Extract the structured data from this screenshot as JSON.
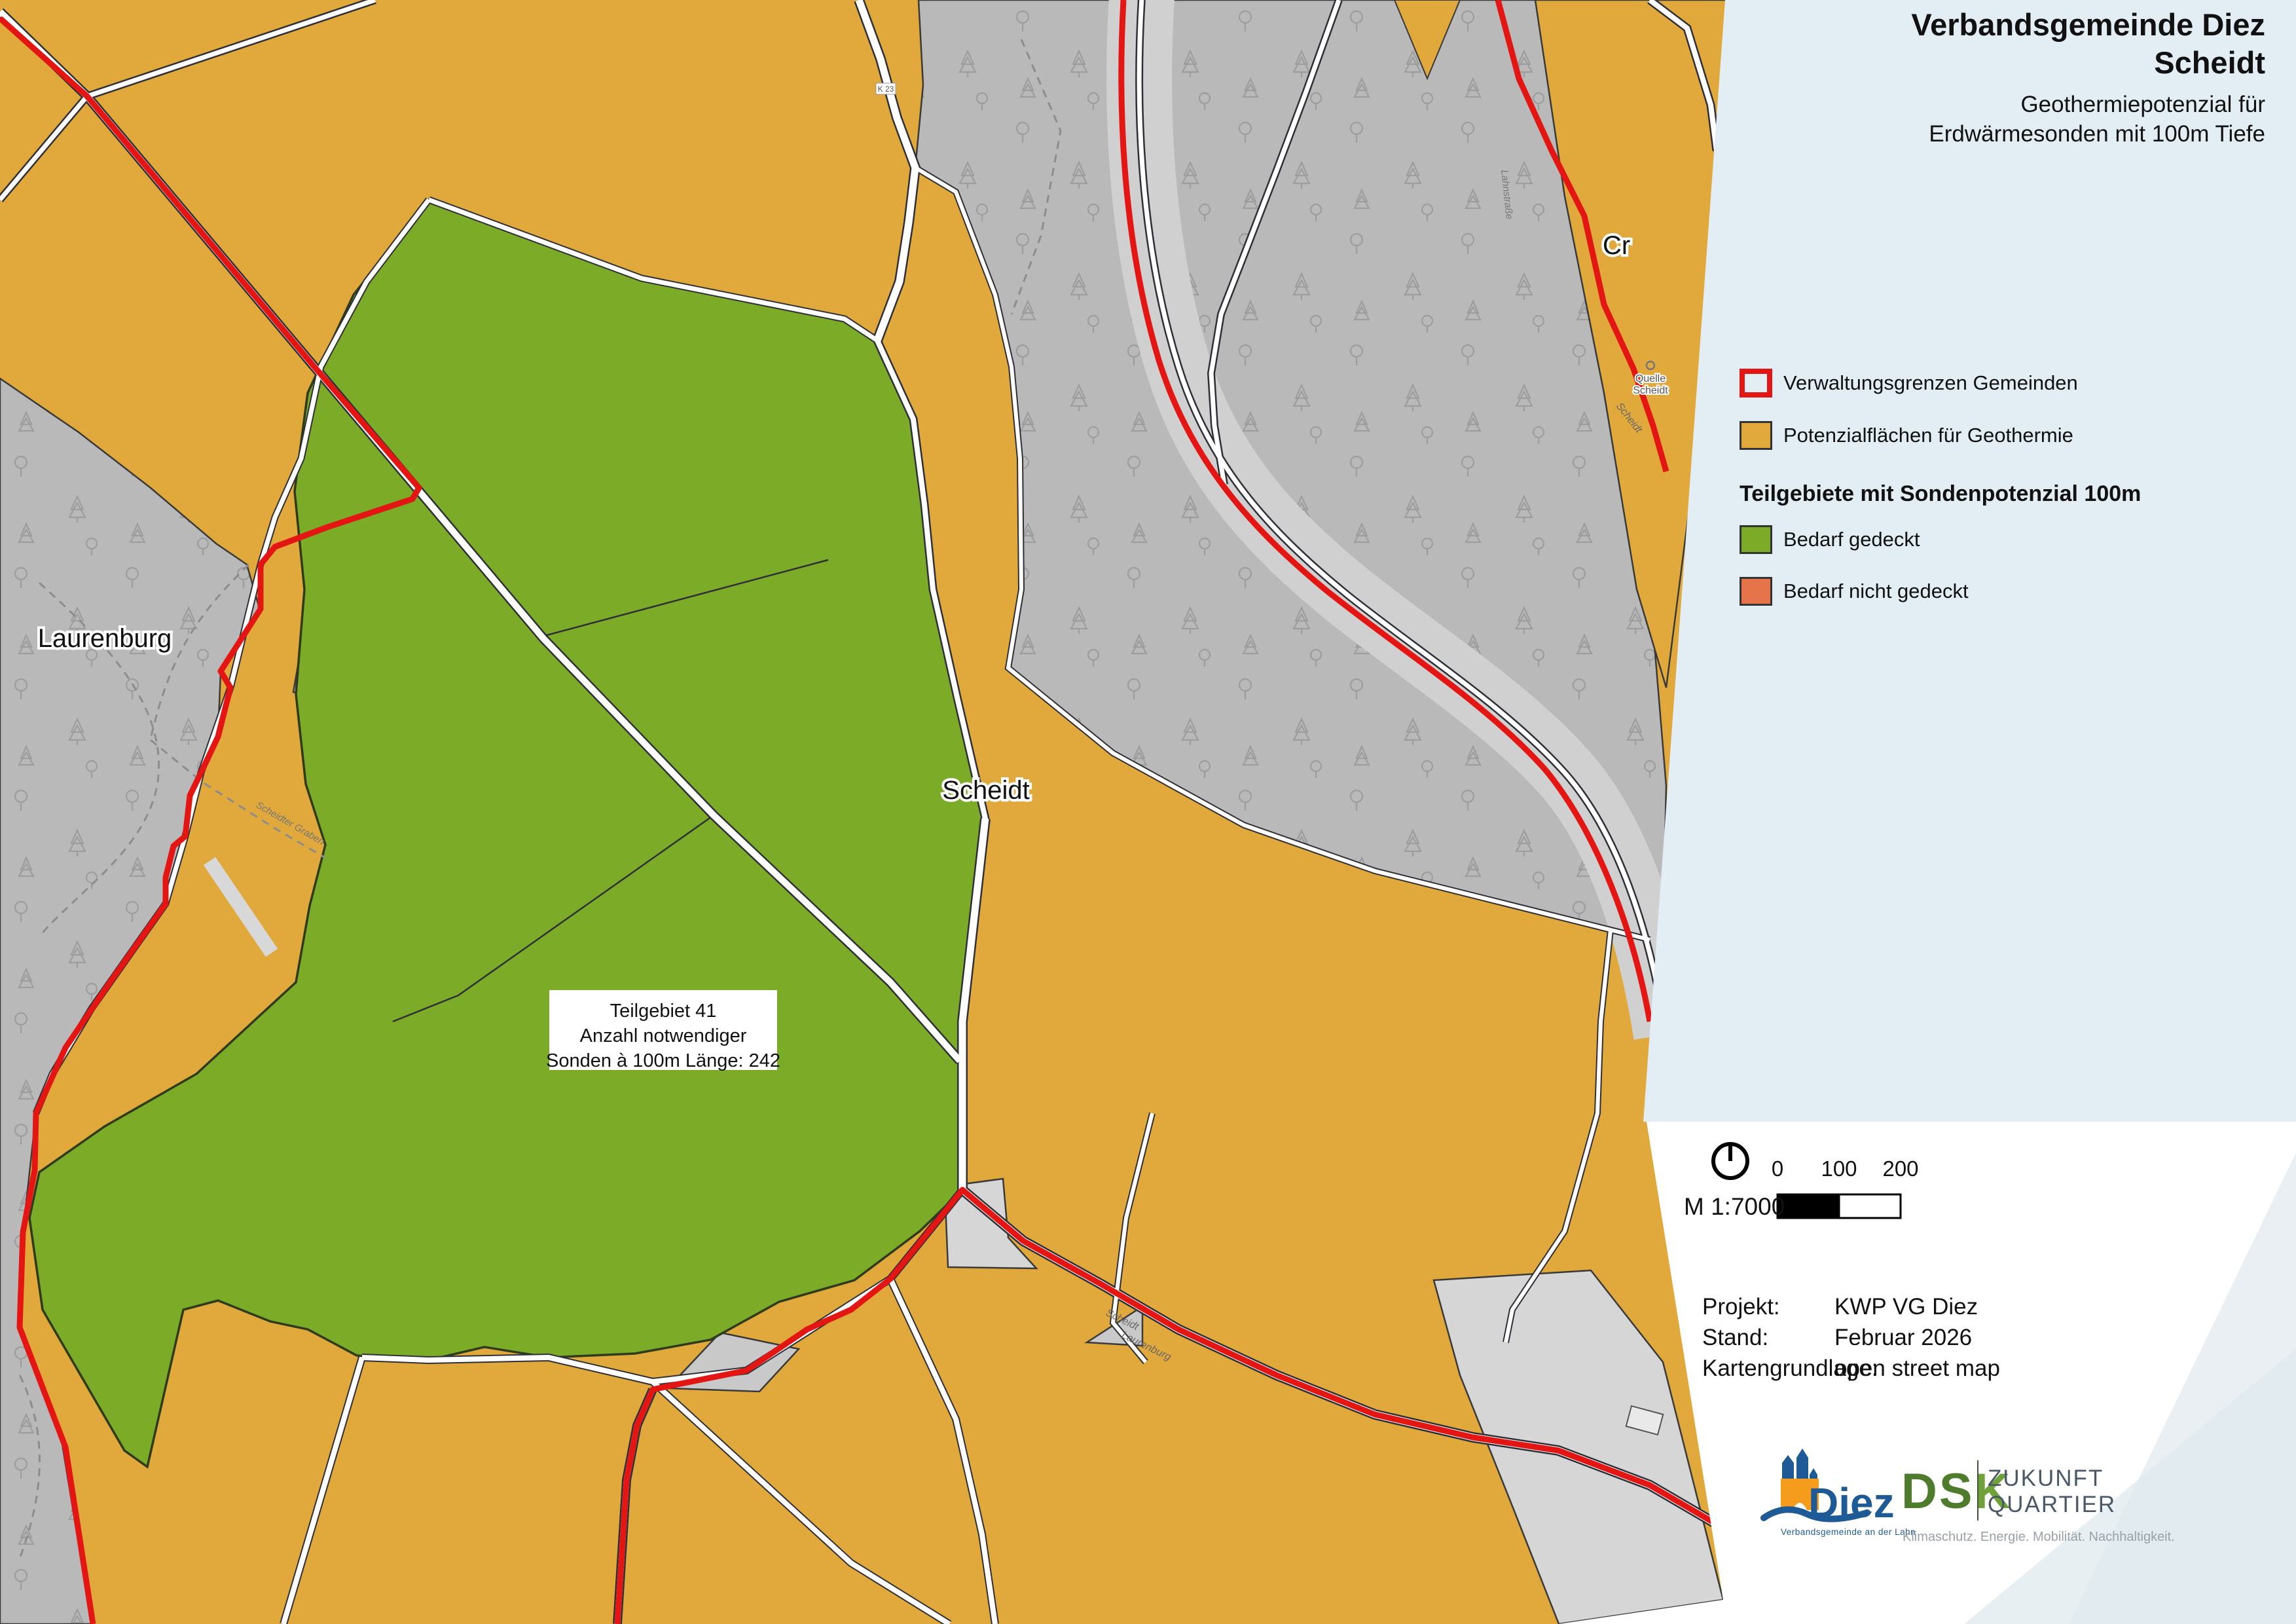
{
  "panel": {
    "title_line1": "Verbandsgemeinde Diez",
    "title_line2": "Scheidt",
    "subtitle_line1": "Geothermiepotenzial für",
    "subtitle_line2": "Erdwärmesonden mit 100m Tiefe",
    "background_color": "#e2edf4"
  },
  "legend": {
    "items": [
      {
        "label": "Verwaltungsgrenzen Gemeinden",
        "swatch": "red-outline",
        "color": "#e31613"
      },
      {
        "label": "Potenzialflächen für Geothermie",
        "swatch": "fill",
        "color": "#e1a93b"
      }
    ],
    "section_header": "Teilgebiete mit Sondenpotenzial 100m",
    "section_items": [
      {
        "label": "Bedarf gedeckt",
        "swatch": "fill",
        "color": "#7cab28"
      },
      {
        "label": "Bedarf nicht gedeckt",
        "swatch": "fill",
        "color": "#e5744b"
      }
    ]
  },
  "map": {
    "annotation_box": {
      "line1": "Teilgebiet 41",
      "line2": "Anzahl notwendiger",
      "line3": "Sonden à 100m Länge: 242"
    },
    "place_labels": {
      "laurenburg": "Laurenburg",
      "scheidt": "Scheidt",
      "cramberg_clipped": "Cr"
    },
    "small_labels": {
      "quelle_line1": "Quelle",
      "quelle_line2": "Scheidt",
      "road_scheidt_upper": "Scheidt",
      "road_scheidt_lower": "Scheidt",
      "road_laurenburg": "Laurenburg",
      "road_lahn": "Lahnstraße",
      "stream": "Scheidter Graben",
      "k23": "K 23"
    },
    "colors": {
      "potential_yellow": "#e1a93b",
      "covered_green": "#7cab28",
      "forest_gray": "#b9b9b9",
      "boundary_red": "#e31613"
    }
  },
  "scalebar": {
    "scale_text": "M 1:7000",
    "ticks": [
      "0",
      "100",
      "200"
    ]
  },
  "project": {
    "rows": [
      {
        "label": "Projekt:",
        "value": "KWP VG Diez"
      },
      {
        "label": "Stand:",
        "value": "Februar 2026"
      },
      {
        "label": "Kartengrundlage:",
        "value": "open street map"
      }
    ]
  },
  "logos": {
    "diez": {
      "name": "Diez",
      "subline": "Verbandsgemeinde an der Lahn"
    },
    "dsk": {
      "name_ds": "DS",
      "name_k": "K",
      "claim_line1": "ZUKUNFT",
      "claim_line2": "QUARTIER",
      "tagline": "Klimaschutz. Energie. Mobilität. Nachhaltigkeit."
    }
  }
}
